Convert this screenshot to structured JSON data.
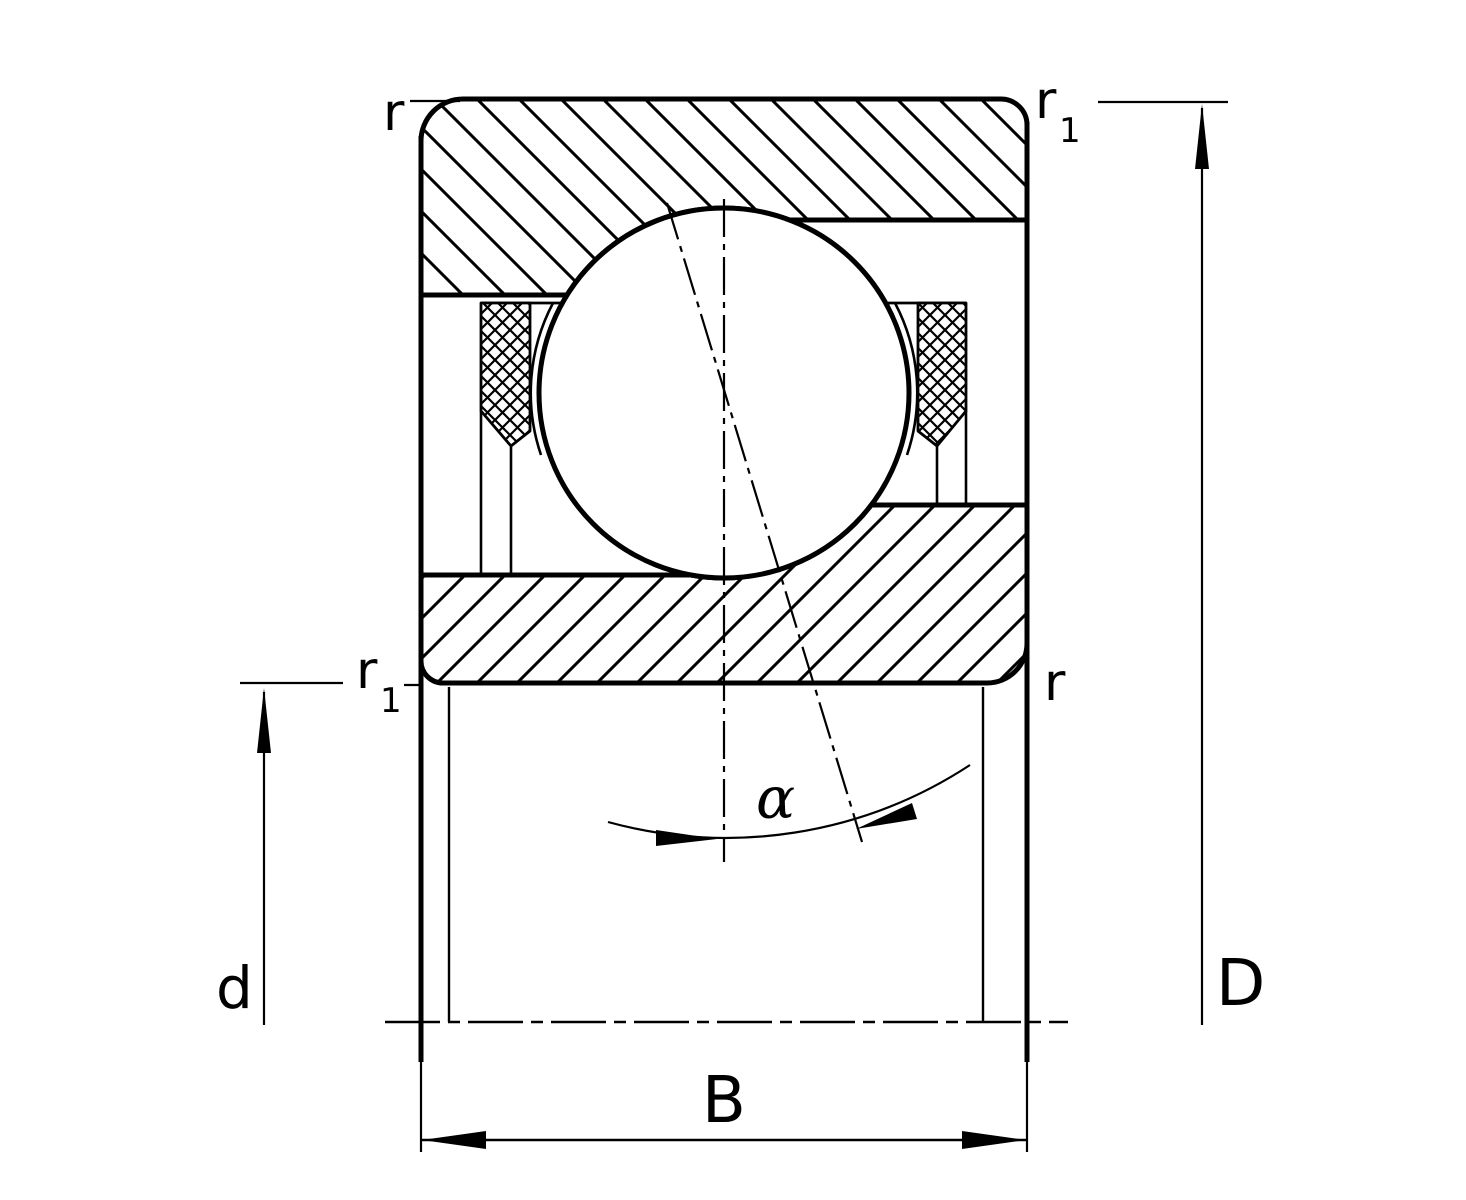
{
  "diagram": {
    "labels": {
      "r": "r",
      "r_sub": "1",
      "bore_diameter": "d",
      "outside_diameter": "D",
      "width": "B",
      "contact_angle": "α"
    },
    "colors": {
      "line": "#000000",
      "background": "#ffffff"
    }
  }
}
